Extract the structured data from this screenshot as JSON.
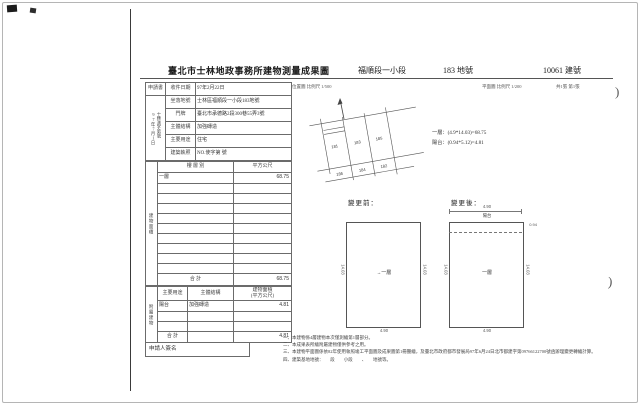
{
  "header": {
    "title": "臺北市士林地政事務所建物測量成果圖",
    "section": "福順段一小段",
    "parcel": "183 地號",
    "building_no": "10061 建號",
    "location_scale": "位置圖 比例尺 1/500",
    "plan_scale": "平面圖 比例尺 1/200",
    "sheet": "共1張 第1張"
  },
  "info_table": {
    "application_label": "申請書",
    "received_date_label": "收件日期",
    "received_date": "97年2月22日",
    "file_no_vertical": "士林測字第號",
    "file_date_vertical": "97年7月1日",
    "rows": [
      {
        "label": "坐落地號",
        "value": "士林區福順段一小段183地號"
      },
      {
        "label": "門牌",
        "value": "臺北市承德路2段300巷55弄3號"
      },
      {
        "label": "主體結構",
        "value": "加強磚造"
      },
      {
        "label": "主要用途",
        "value": "住宅"
      },
      {
        "label": "建築執照",
        "value": "NO.使字第 號"
      }
    ]
  },
  "floor_table": {
    "side_label": "建物面積",
    "col_floor": "樓 層 別",
    "col_area": "平方公尺",
    "rows": [
      {
        "floor": "一層",
        "area": "68.75"
      }
    ],
    "total_label": "合  計",
    "total": "68.75"
  },
  "annex_table": {
    "side_label": "附屬建物",
    "col_use": "主要用途",
    "col_structure": "主體結構",
    "col_area": "建物面積",
    "col_area2": "(平方公尺)",
    "rows": [
      {
        "use": "陽台",
        "structure": "加強磚造",
        "area": "4.81"
      }
    ],
    "total_label": "合  計",
    "total": "4.81"
  },
  "signer_label": "申請人簽名",
  "location_sketch": {
    "parcels": [
      "181",
      "183",
      "185",
      "186",
      "184",
      "182"
    ]
  },
  "formulas": {
    "line1": "一層：(4.9*14.03)=68.75",
    "line2": "陽台：(0.94*5.12)=4.81"
  },
  "diagrams": {
    "before_label": "變更前：",
    "after_label": "變更後：",
    "floor_label": "一層",
    "balcony_label": "陽台",
    "width": "4.90",
    "height": "14.03",
    "balcony_depth": "0.94"
  },
  "notes": {
    "lines": [
      "一、本建物係4層建物本次僅測繪第1層部分。",
      "二、本成果表所繪附屬建物僅供參考之用。",
      "三、本建物平面圖係依82年使用執照竣工平面圖及成果圖第1冊謄繪，及臺北市政府都市發展局97年6月24日北市都建字第09766122700號函辦理變更轉繪計算。",
      "四、建築基地地號：　　段　　小段　　、　　地號等。"
    ]
  }
}
